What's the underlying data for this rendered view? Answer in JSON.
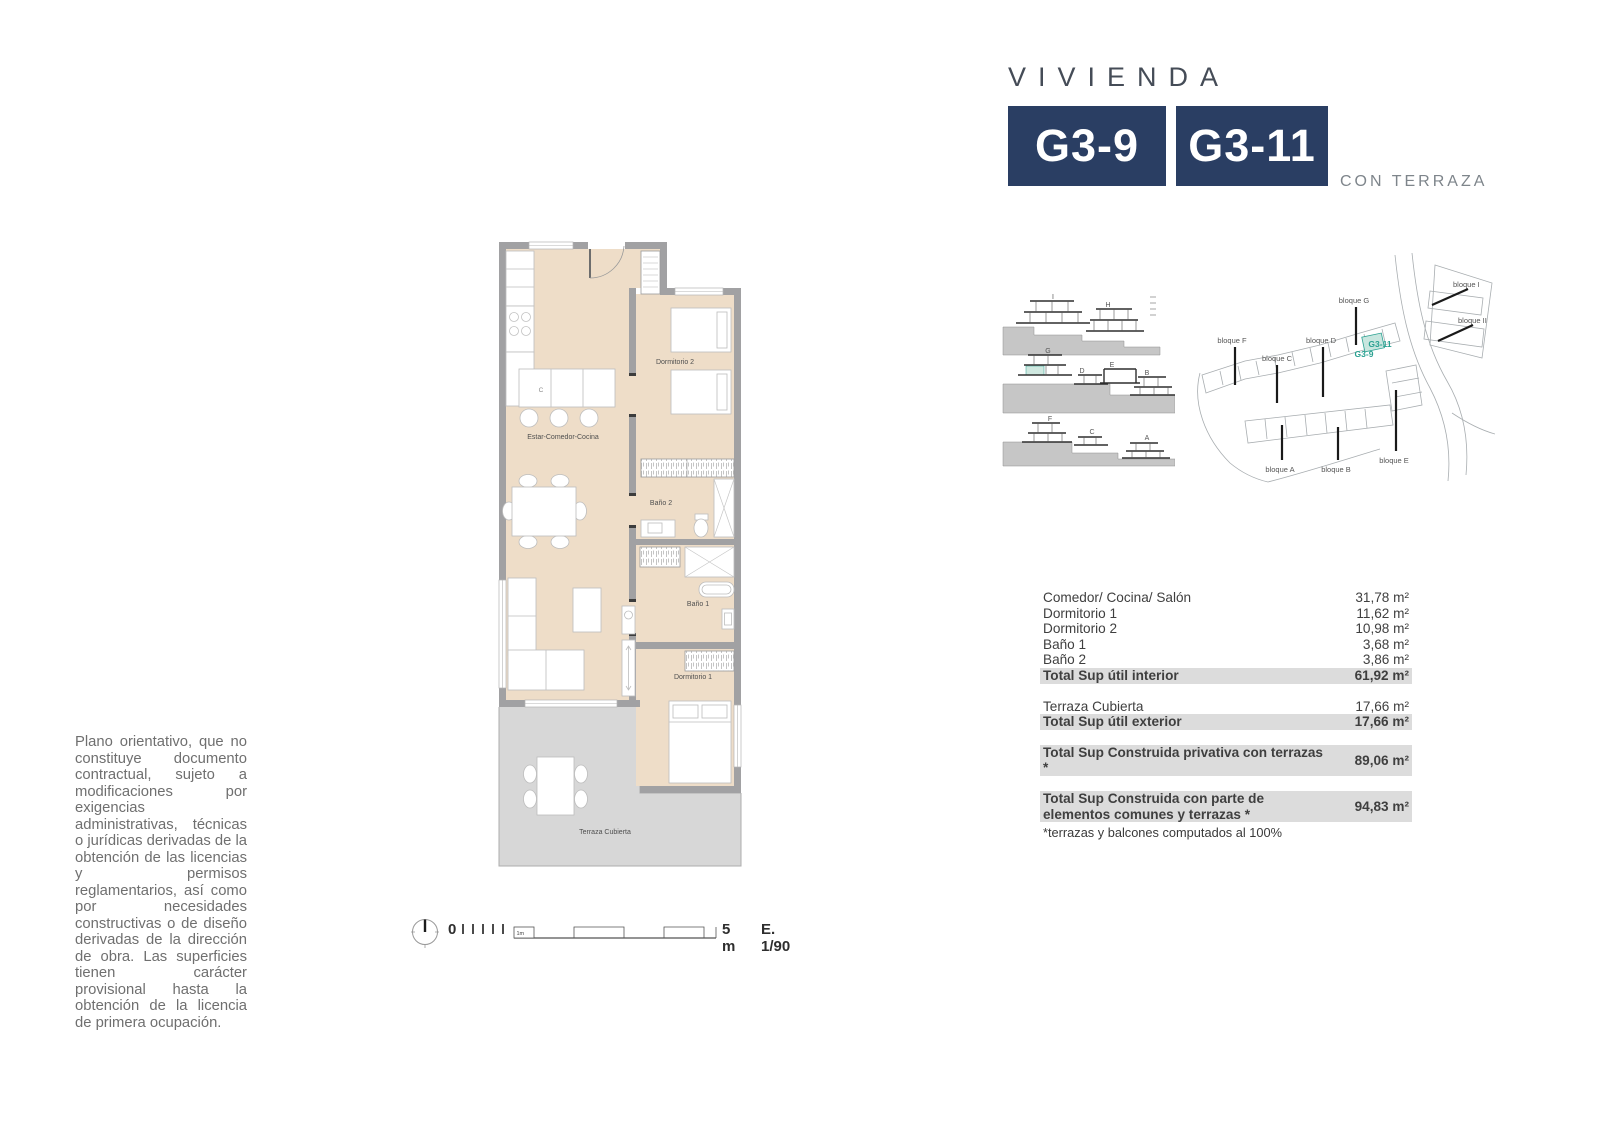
{
  "header": {
    "title": "VIVIENDA",
    "badges": [
      "G3-9",
      "G3-11"
    ],
    "subtitle": "CON TERRAZA"
  },
  "disclaimer": {
    "text": "Plano orientativo, que no constituye documento contractual, sujeto a modificaciones por exigencias administrativas, técnicas o jurídicas derivadas de la obtención de las licencias y permisos reglamentarios, así como por necesidades constructivas o de diseño derivadas de la dirección de obra. Las superficies tienen carácter provisional hasta la obtención de la licencia de primera ocupación."
  },
  "plan": {
    "labels": {
      "living": "Estar-Comedor-Cocina",
      "bedroom2": "Dormitorio 2",
      "bath2": "Baño 2",
      "bath1": "Baño 1",
      "bedroom1": "Dormitorio 1",
      "terrace": "Terraza Cubierta",
      "counter": "C"
    }
  },
  "scale_bar": {
    "zero": "0",
    "one_m": "1m",
    "five_m": "5 m",
    "ratio": "E. 1/90"
  },
  "elevations": {
    "row1": [
      "I",
      "H"
    ],
    "row2": [
      "G",
      "D",
      "E",
      "B"
    ],
    "row3": [
      "F",
      "C",
      "A"
    ]
  },
  "site_map": {
    "blocks": [
      "bloque G",
      "bloque F",
      "bloque C",
      "bloque D",
      "bloque A",
      "bloque B",
      "bloque E",
      "bloque I",
      "bloque II"
    ],
    "units": [
      "G3-11",
      "G3-9"
    ]
  },
  "area_table": {
    "rows": [
      {
        "label": "Comedor/ Cocina/ Salón",
        "value": "31,78 m²"
      },
      {
        "label": "Dormitorio 1",
        "value": "11,62 m²"
      },
      {
        "label": "Dormitorio 2",
        "value": "10,98 m²"
      },
      {
        "label": "Baño 1",
        "value": "3,68 m²"
      },
      {
        "label": "Baño 2",
        "value": "3,86 m²"
      },
      {
        "label": "Total Sup útil interior",
        "value": "61,92 m²"
      },
      {
        "label": "Terraza Cubierta",
        "value": "17,66 m²"
      },
      {
        "label": "Total Sup útil exterior",
        "value": "17,66 m²"
      },
      {
        "label": "Total Sup Construida privativa con terrazas *",
        "value": "89,06 m²"
      },
      {
        "label": "Total Sup Construida con parte de elementos comunes y terrazas *",
        "value": "94,83 m²"
      }
    ],
    "footnote": "*terrazas y balcones computados al 100%"
  },
  "colors": {
    "navy": "#2a3e63",
    "teal": "#2aa191",
    "teal_light": "#c8e6df",
    "floor_beige": "#eeddc8",
    "wall_gray": "#a1a1a3",
    "terrace_gray": "#d7d7d7",
    "row_highlight": "#dcdcdc"
  }
}
